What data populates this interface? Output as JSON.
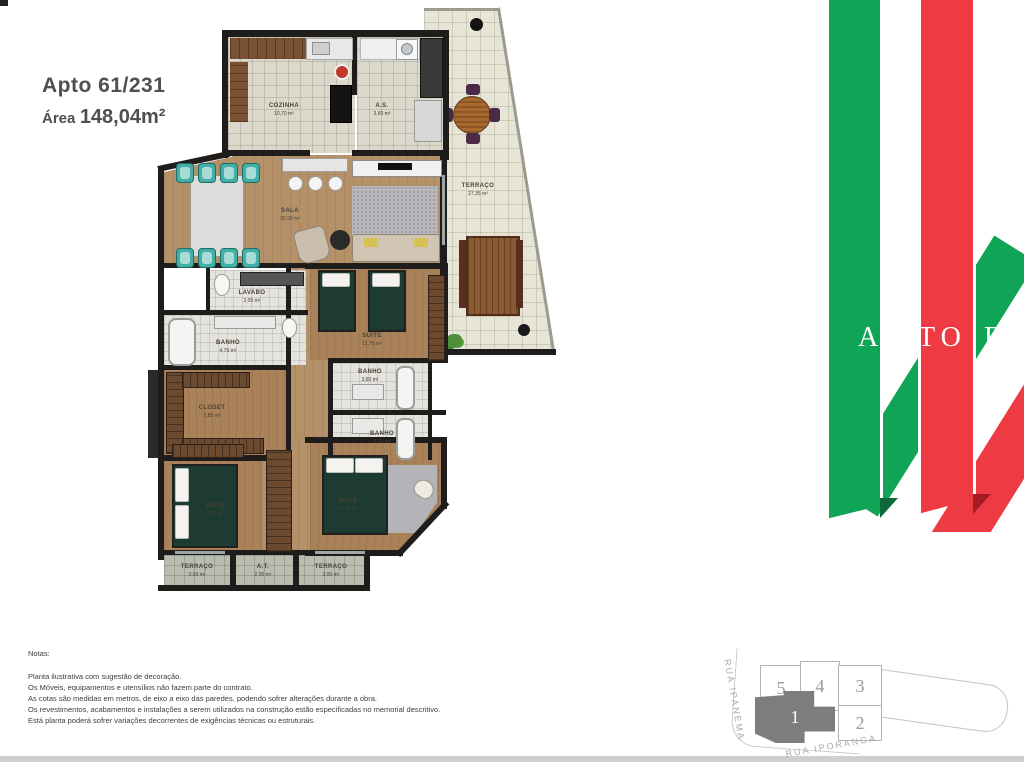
{
  "header": {
    "apto_label": "Apto 61/231",
    "area_label": "Área",
    "area_value": "148,04m²"
  },
  "floor_plan": {
    "rooms": {
      "cozinha": {
        "name": "COZINHA",
        "area": "10,70 m²"
      },
      "servico": {
        "name": "A.S.",
        "area": "3,60 m²"
      },
      "terraco": {
        "name": "TERRAÇO",
        "area": "27,35 m²"
      },
      "sala": {
        "name": "SALA",
        "area": "30,90 m²"
      },
      "lavabo": {
        "name": "LAVABO",
        "area": "2,05 m²"
      },
      "banho_m": {
        "name": "BANHO",
        "area": "4,70 m²"
      },
      "closet": {
        "name": "CLOSET",
        "area": "5,85 m²"
      },
      "suite_mid": {
        "name": "SUÍTE",
        "area": "11,75 m²"
      },
      "banho1": {
        "name": "BANHO",
        "area": "3,60 m²"
      },
      "banho2": {
        "name": "BANHO",
        "area": "2,75 m²"
      },
      "suite_esq": {
        "name": "SUÍTE",
        "area": "9,75 m²"
      },
      "suite_dir": {
        "name": "SUÍTE",
        "area": "16,29 m²"
      },
      "terraco_b1": {
        "name": "TERRAÇO",
        "area": "3,00 m²"
      },
      "at": {
        "name": "A.T.",
        "area": "2,00 m²"
      },
      "terraco_b2": {
        "name": "TERRAÇO",
        "area": "3,00 m²"
      }
    }
  },
  "notes": {
    "heading": "Notas:",
    "line1": "Planta ilustrativa com sugestão de decoração.",
    "line2": "Os Móveis, equipamentos e utensílios não fazem parte do contrato.",
    "line3": "As cotas são medidas em metros, de eixo a eixo das paredes, podendo sofrer alterações durante a obra.",
    "line4": "Os revestimentos, acabamentos e instalações a serem utilizados na construção estão especificadas no memorial descritivo.",
    "line5": "Está planta poderá sofrer variações decorrentes de exigências técnicas ou estruturais."
  },
  "logo": {
    "letters_a": "A",
    "letters_to": "TO",
    "letters_fi": "FI",
    "green": "#10A456",
    "green_dark": "#0B6B3A",
    "red": "#EE3A42",
    "red_dark": "#A31C24"
  },
  "site_plan": {
    "street_left": "RUA IPANEMA",
    "street_bottom": "RUA IPORANGA",
    "units": {
      "u5": "5",
      "u4": "4",
      "u3": "3",
      "u2": "2",
      "u1": "1"
    },
    "highlight_color": "#7d7d7d"
  }
}
